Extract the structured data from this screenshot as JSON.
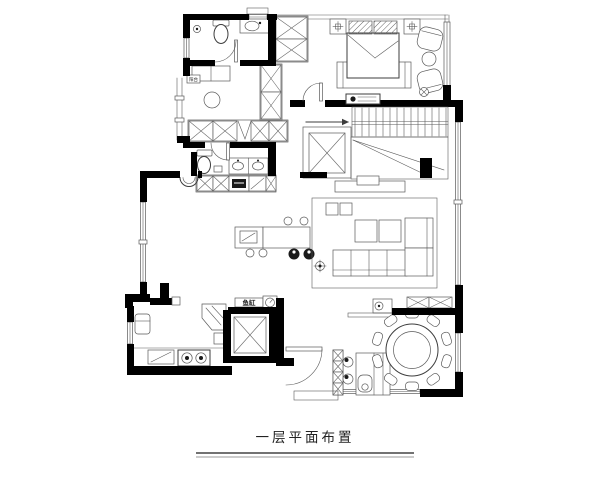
{
  "title": "一层平面布置",
  "labels": {
    "fish_tank": "鱼缸",
    "closet_note": "阳台"
  },
  "colors": {
    "background": "#ffffff",
    "wall": "#000000",
    "line": "#3d3d3d"
  }
}
